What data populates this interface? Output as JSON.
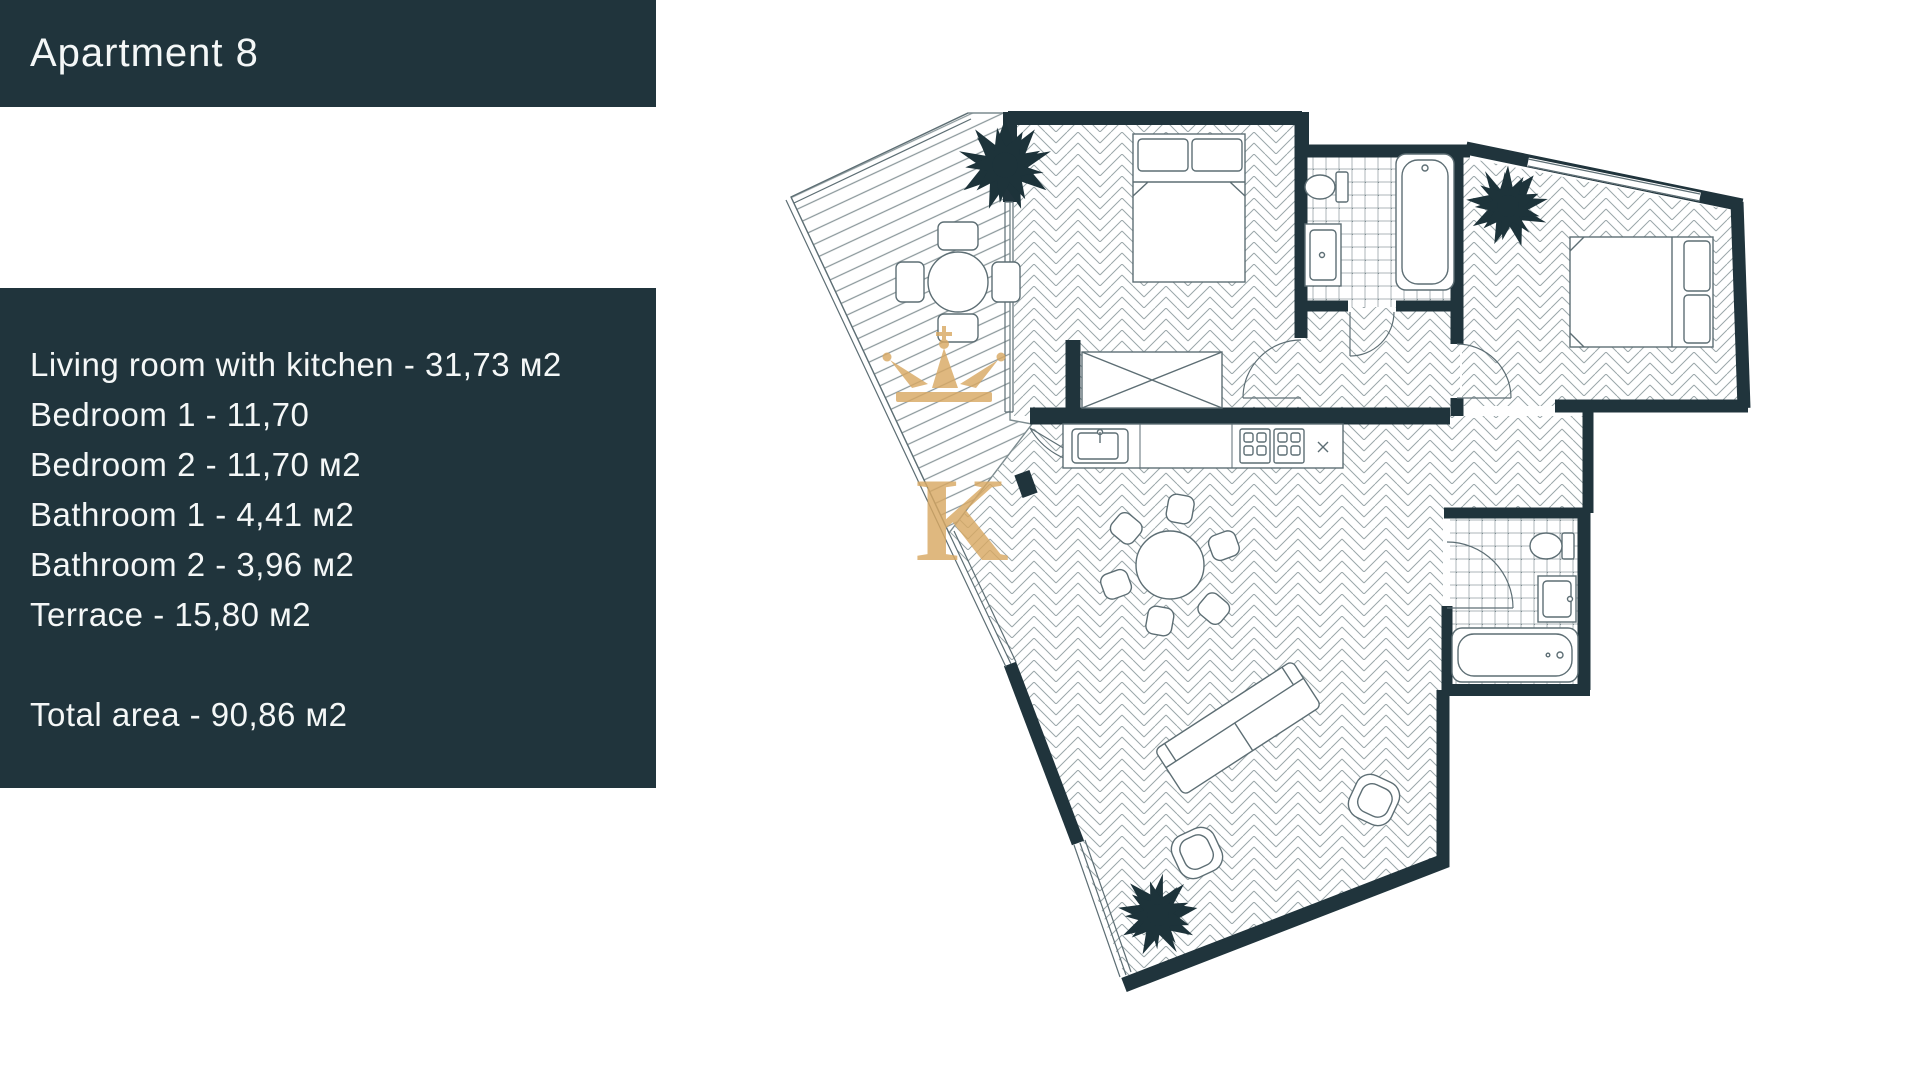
{
  "header": {
    "title": "Apartment 8"
  },
  "info": {
    "lines": [
      "Living room with kitchen - 31,73 м2",
      "Bedroom 1 - 11,70",
      "Bedroom 2 - 11,70 м2",
      "Bathroom 1 - 4,41 м2",
      "Bathroom 2 - 3,96 м2",
      "Terrace - 15,80 м2"
    ],
    "total": "Total area - 90,86 м2"
  },
  "watermark": {
    "letter": "K"
  },
  "colors": {
    "panel_and_walls": "#20343c",
    "watermark_gold": "#d9a963",
    "floor_lines": "#8b989b",
    "fixture_lines": "#5d6e74",
    "background": "#ffffff"
  },
  "plan_rooms": [
    "terrace",
    "bedroom-1",
    "bathroom-1",
    "bedroom-2",
    "bathroom-2",
    "living-room-with-kitchen",
    "corridor"
  ]
}
